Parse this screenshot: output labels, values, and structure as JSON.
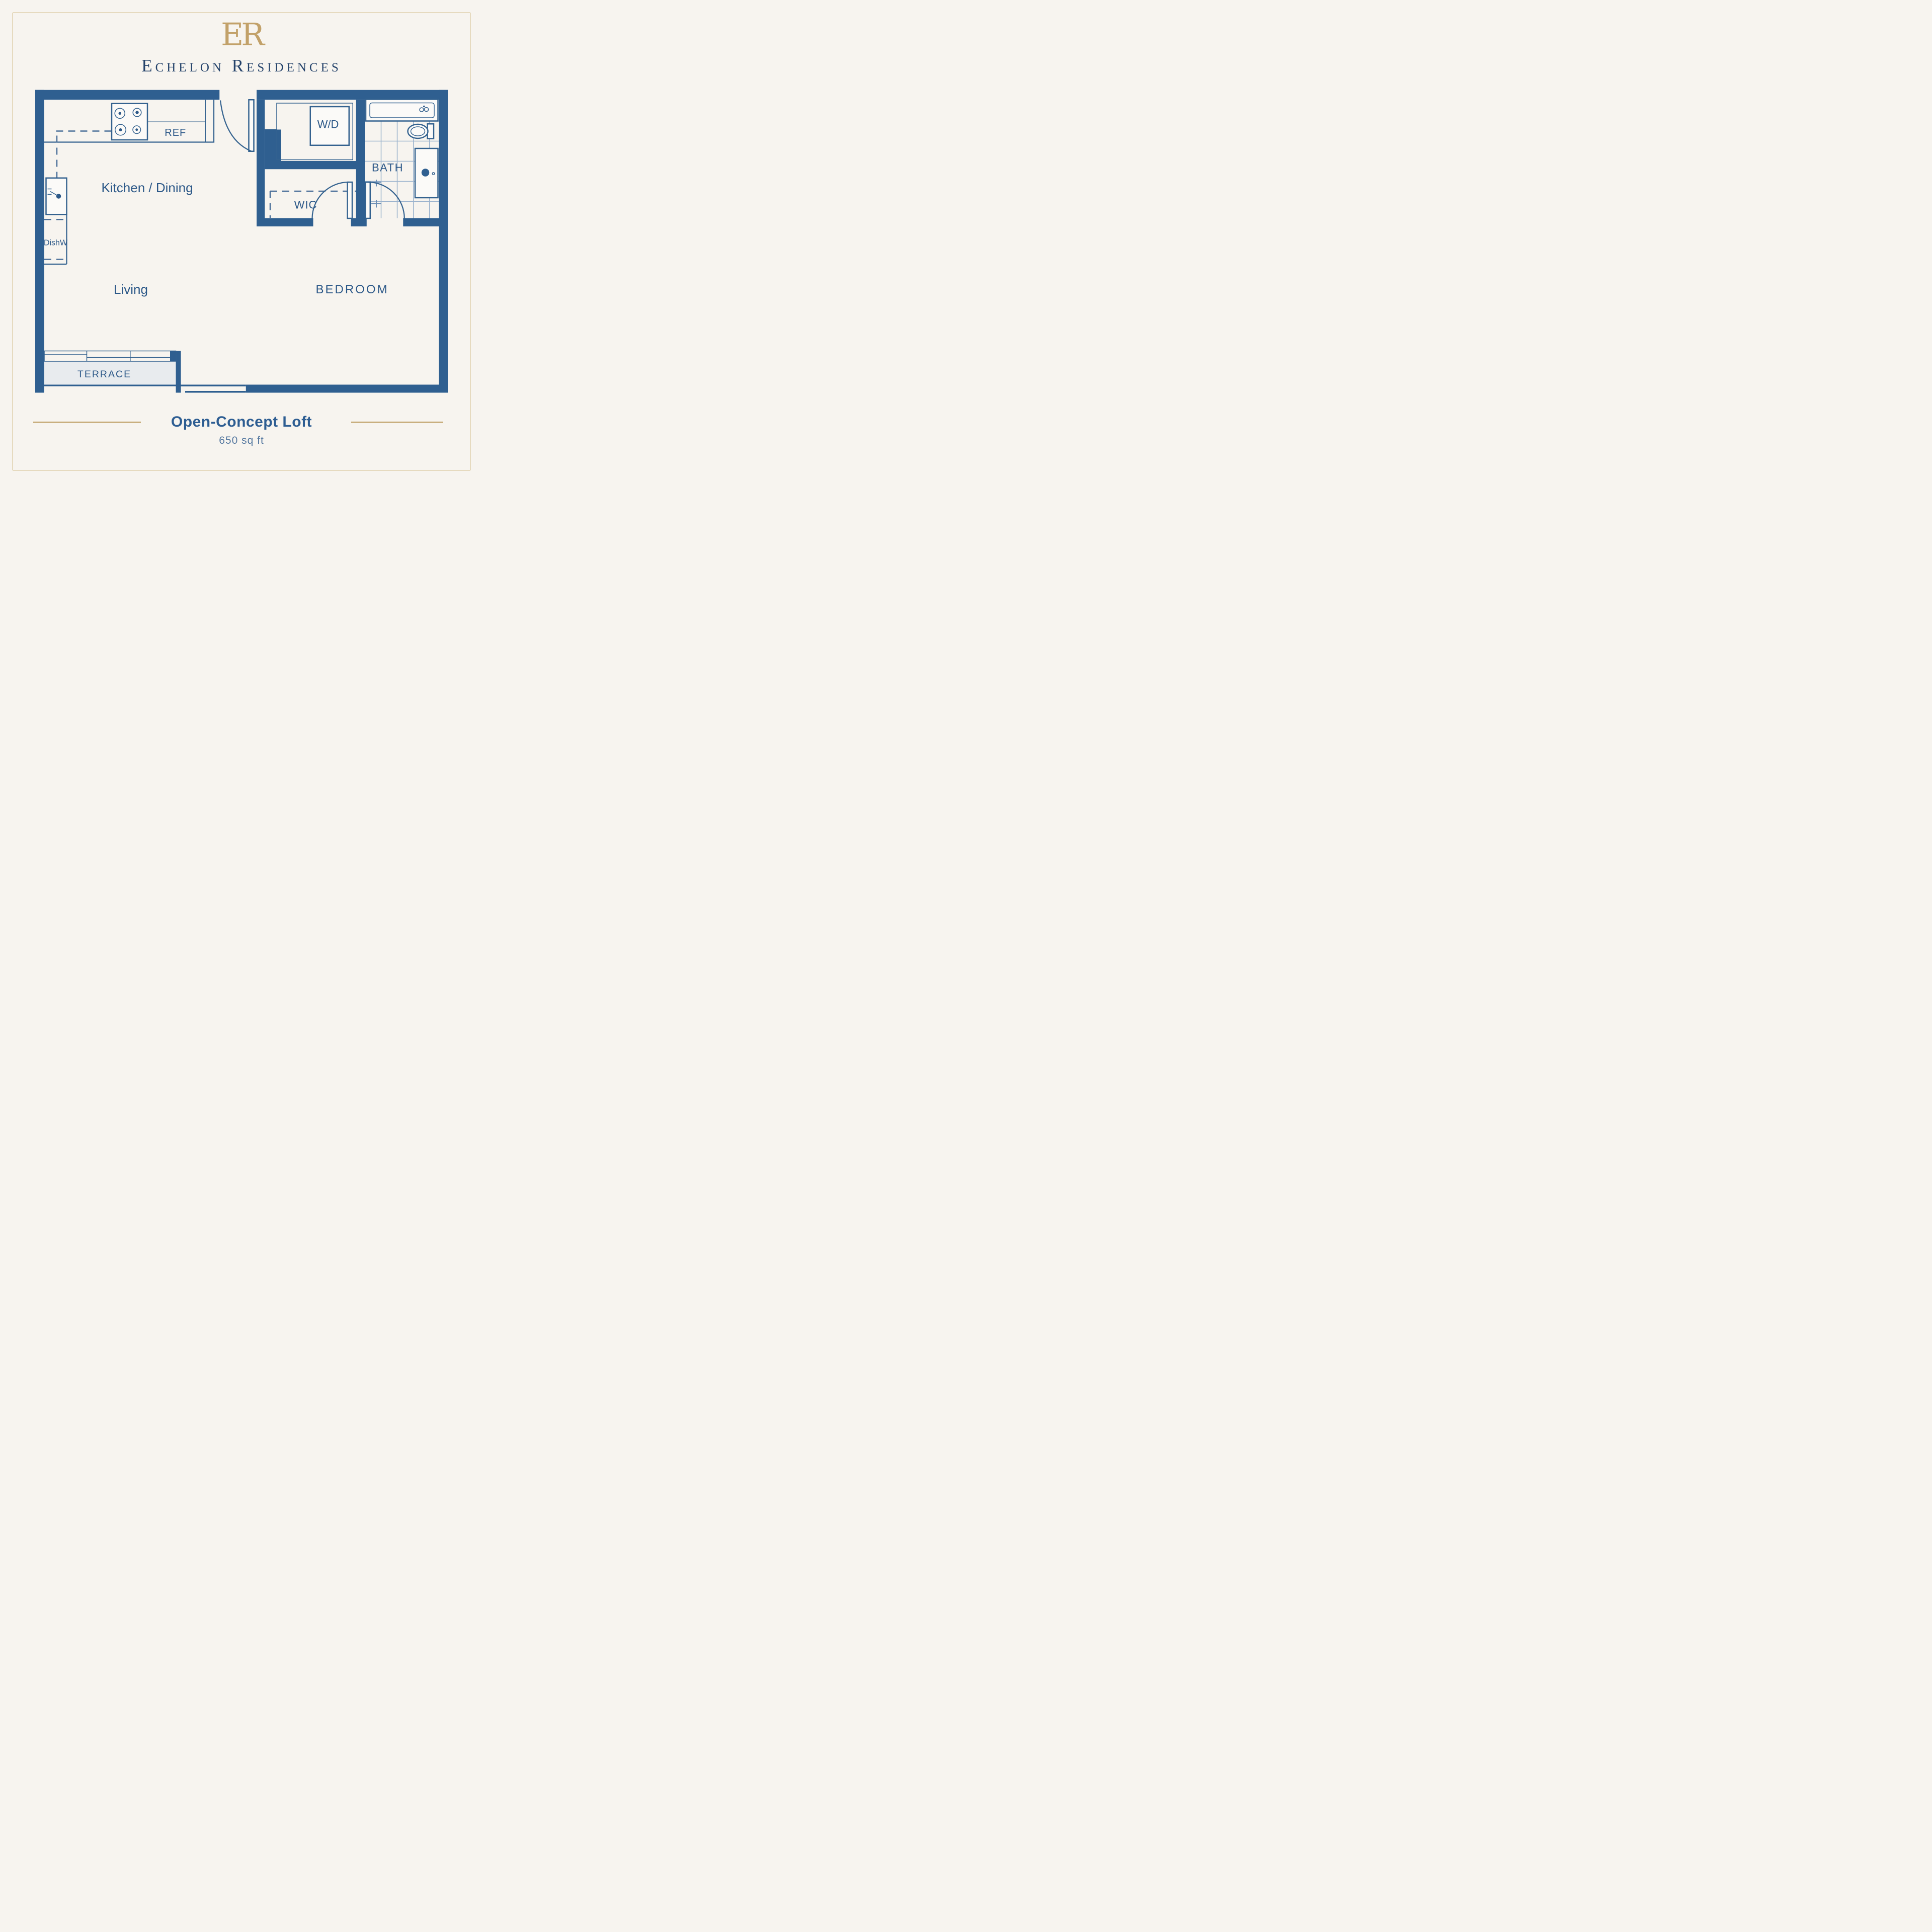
{
  "brand": {
    "logo_text": "ER",
    "name": "Echelon Residences"
  },
  "rooms": {
    "kitchen": "Kitchen / Dining",
    "living": "Living",
    "bedroom": "BEDROOM",
    "wic": "WIC",
    "bath": "BATH",
    "terrace": "TERRACE"
  },
  "fixtures": {
    "ref": "REF",
    "dishwasher": "DishW",
    "washer_dryer": "W/D"
  },
  "footer": {
    "plan_name": "Open-Concept Loft",
    "area": "650 sq ft"
  },
  "colors": {
    "wall_navy": "#2f5f90",
    "label_navy": "#2c5888",
    "title_navy": "#24426a",
    "logo_gold": "#c2a169",
    "frame_gold": "#c6a863",
    "divider_gold": "#b9985a",
    "background_cream": "#f7f4ef",
    "terrace_fill": "#e8ebee"
  }
}
